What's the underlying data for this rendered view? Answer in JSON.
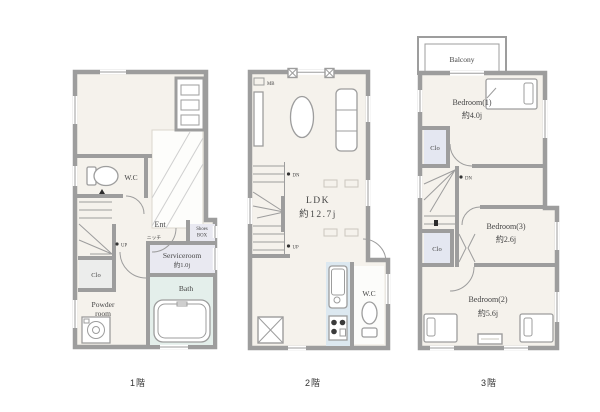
{
  "palette": {
    "wall": "#9d9d9d",
    "room_beige": "#f5f2ec",
    "bath_green": "#e4efeb",
    "kitchen_blue": "#dce8f0",
    "closet_gray": "#e4e7f1",
    "service_gray": "#e9e9f1",
    "text": "#454545"
  },
  "floors": {
    "f1": {
      "label": "1階",
      "wc": "W.C",
      "ent": "Ent",
      "shoes_lines": [
        "Shoes",
        "BOX"
      ],
      "service_name": "Serviceroom",
      "service_size": "約1.0j",
      "bath": "Bath",
      "clo": "Clo",
      "powder_lines": [
        "Powder",
        "room"
      ],
      "niche": "ニッチ",
      "up": "UP"
    },
    "f2": {
      "label": "2階",
      "ldk_name": "LDK",
      "ldk_size": "約12.7j",
      "wc": "W.C",
      "mb": "MB",
      "dn": "DN",
      "up": "UP"
    },
    "f3": {
      "label": "3階",
      "balcony": "Balcony",
      "bedroom1_name": "Bedroom(1)",
      "bedroom1_size": "約4.0j",
      "bedroom3_name": "Bedroom(3)",
      "bedroom3_size": "約2.6j",
      "bedroom2_name": "Bedroom(2)",
      "bedroom2_size": "約5.6j",
      "clo_upper": "Clo",
      "clo_lower": "Clo",
      "dn": "DN"
    }
  }
}
